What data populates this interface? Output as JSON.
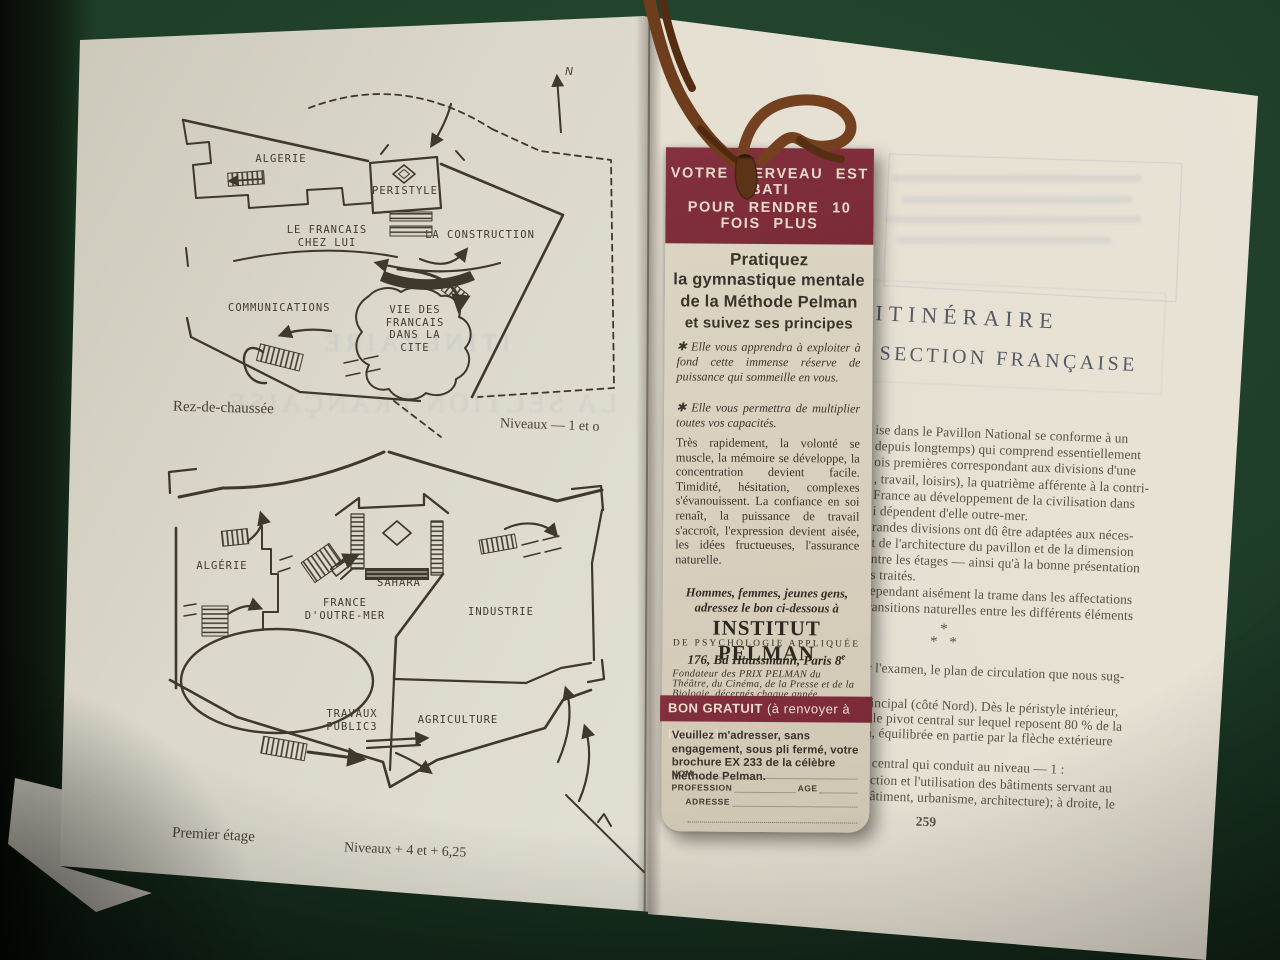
{
  "colors": {
    "table_green": "#1e3d28",
    "page_cream": "#e2dfd3",
    "ink": "#3e382d",
    "bookmark_red": "#7d2c3a",
    "bookmark_paper": "#d8d0be",
    "ribbon_brown": "#74431f"
  },
  "left_page": {
    "north_label": "N",
    "ghost_line1": "ITINERAIRE",
    "ghost_line2": "LA SECTION FRANÇAISE",
    "ground_plan": {
      "algerie": "ALGERIE",
      "peristyle": "PERISTYLE",
      "francais_chez_lui": "LE FRANCAIS\nCHEZ LUI",
      "la_construction": "LA CONSTRUCTION",
      "communications": "COMMUNICATIONS",
      "vie_des_francais": "VIE DES\nFRANCAIS\nDANS LA\nCITE",
      "caption_left": "Rez-de-chaussée",
      "caption_right": "Niveaux — 1 et o"
    },
    "first_floor_plan": {
      "algerie": "ALGÉRIE",
      "sahara": "SAHARA",
      "france_outre_mer": "FRANCE\nD'OUTRE-MER",
      "industrie": "INDUSTRIE",
      "travaux_publics": "TRAVAUX\nPUBLIC3",
      "agriculture": "AGRICULTURE",
      "caption_left": "Premier étage",
      "caption_right": "Niveaux + 4 et + 6,25"
    }
  },
  "bookmark": {
    "header_line1": "VOTRE CERVEAU EST BATI",
    "header_line2": "POUR RENDRE 10 FOIS PLUS",
    "intro_line1": "Pratiquez",
    "intro_line2": "la gymnastique mentale",
    "intro_line3": "de la Méthode Pelman",
    "intro_line4": "et suivez ses principes",
    "bullet1": "✱  Elle vous apprendra à exploiter à fond cette immense réserve de puissance qui sommeille en vous.",
    "bullet2": "✱  Elle vous permettra de multiplier toutes vos capacités.",
    "paragraph": "Très rapidement, la volonté se muscle, la mémoire se développe, la concentration devient facile. Timidité, hésitation, complexes s'évanouissent. La confiance en soi renaît, la puissance de travail s'accroît, l'expression devient aisée, les idées fructueuses, l'assurance naturelle.",
    "appeal": "Hommes, femmes, jeunes gens, adressez le bon ci-dessous à",
    "institute_name": "INSTITUT PELMAN",
    "institute_sub": "DE PSYCHOLOGIE APPLIQUÉE",
    "institute_address": "176, Bd Haussmann, Paris 8",
    "institute_address_sup": "e",
    "founder_note": "Fondateur des PRIX PELMAN du Théâtre, du Cinéma, de la Presse et de la Biologie, décernés chaque année.",
    "coupon_band_bold": "BON GRATUIT ",
    "coupon_band_rest": "(à renvoyer à Pelman)",
    "coupon_text": "Veuillez m'adresser, sans engagement, sous pli fermé, votre brochure EX 233 de la célèbre Méthode Pelman.",
    "form_nom": "NOM",
    "form_profession": "PROFESSION",
    "form_age": "AGE",
    "form_adresse": "ADRESSE"
  },
  "right_page": {
    "heading_line1": "ITINÉRAIRE",
    "heading_line2": "SECTION FRANÇAISE",
    "lines": [
      "ise dans le Pavillon National se conforme à un",
      "depuis longtemps) qui comprend essentiellement",
      "ois premières correspondant aux divisions d'une",
      ", travail, loisirs), la quatrième afférente à la contri-",
      "France au développement de la civilisation dans",
      "i dépendent d'elle outre-mer.",
      "randes divisions ont dû être adaptées aux néces-",
      "t de l'architecture du pavillon et de la dimension",
      "ntre les étages — ainsi qu'à la bonne présentation",
      "s traités.",
      "ependant aisément la trame dans les affectations",
      "transitions naturelles entre les différents éléments",
      "r l'examen, le plan de circulation que nous sug-",
      "rincipal (côté Nord). Dès le péristyle intérieur,",
      "t le pivot central sur lequel reposent 80 % de la",
      "n, équilibrée en partie par la flèche extérieure",
      "r central qui conduit au niveau — 1 :",
      "uction et l'utilisation des bâtiments servant au",
      "bâtiment, urbanisme, architecture); à droite, le"
    ],
    "asterism": "*\n*  *",
    "page_number": "259"
  }
}
